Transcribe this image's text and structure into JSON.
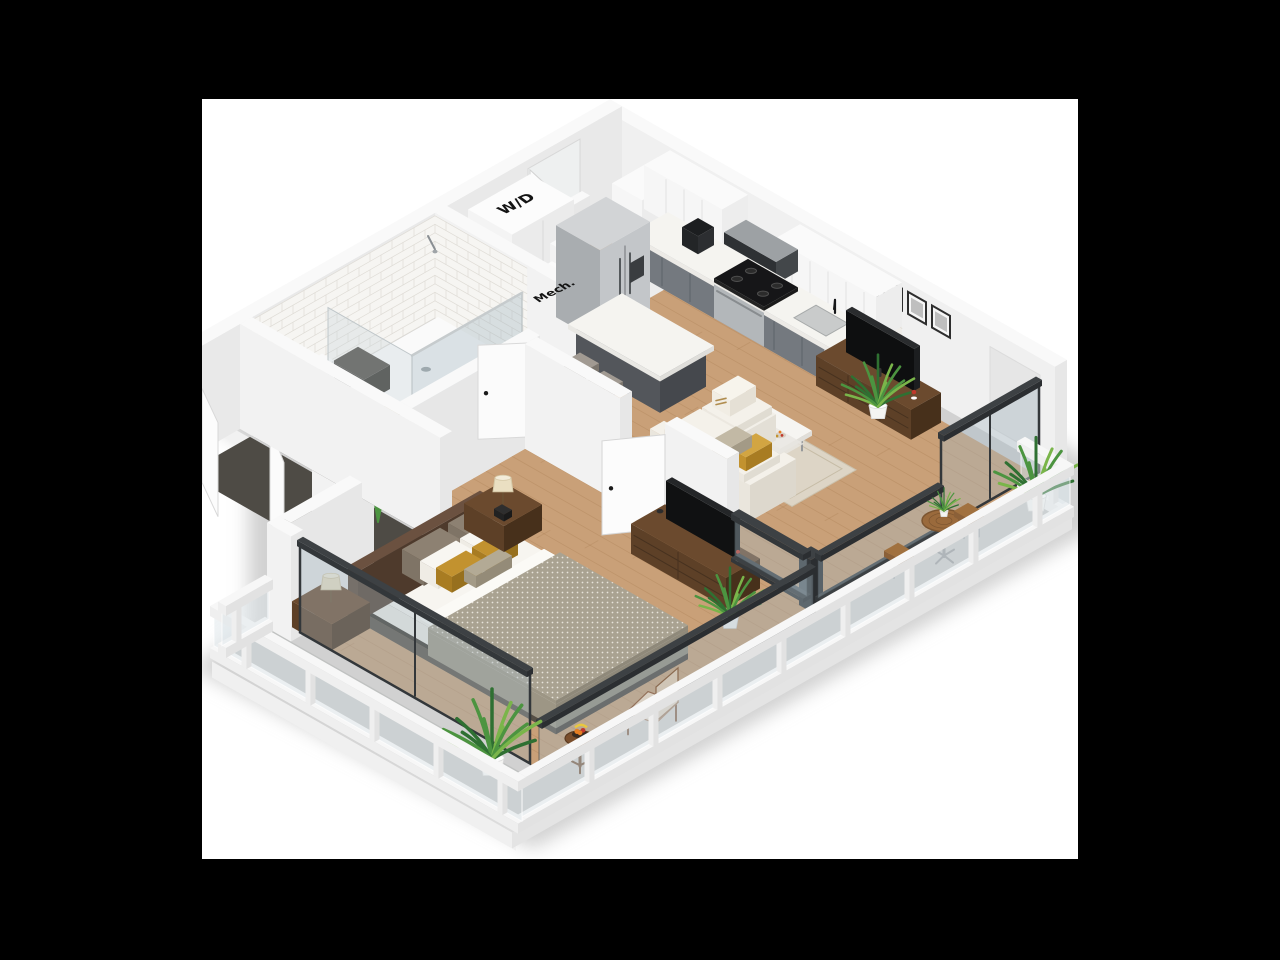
{
  "scene": {
    "description": "3D isometric rendering of a one-bedroom apartment floor plan on a white card over a black background",
    "canvas": {
      "x": 202,
      "y": 99,
      "width": 876,
      "height": 760
    }
  },
  "labels": {
    "washer_dryer": "W/D",
    "mechanical": "Mech."
  },
  "palette": {
    "background": "#000000",
    "canvas": "#ffffff",
    "shadow": "#c6c6c6",
    "wallTop": "#f9f9f9",
    "wallInnerNE": "#f0f0f0",
    "wallInnerNW": "#e9e9e9",
    "wallCap": "#e7e7e7",
    "wallOuter": "#f2f2f2",
    "wood": "#c9a078",
    "woodLine": "#a87e52",
    "tileFloor": "#edebe7",
    "tileLine": "#d9d6d0",
    "tileWall": "#f6f5f2",
    "tileWallLine": "#dfdcd6",
    "concrete": "#c0c2c1",
    "rug": "#ddd5c6",
    "closetFloor": "#4e4b45",
    "cabinetGray": "#74797f",
    "cabinetGrayDark": "#60656b",
    "islandGray": "#53565b",
    "counter": "#f5f4f0",
    "steel": "#c3c6c9",
    "steelSide": "#a9adb0",
    "applianceBlack": "#222426",
    "walnut": "#5d4027",
    "walnutDark": "#47301b",
    "sofa": "#efece5",
    "cushion": "#f4f1ea",
    "mattress": "#f7f5f0",
    "duvet": "#a9a291",
    "sheet": "#fbfaf6",
    "mustard": "#c2922f",
    "taupe": "#8d8172",
    "headboard": "#5a4434",
    "frameDark": "#33373a",
    "glass": "rgba(165,185,195,0.38)",
    "glassLight": "rgba(195,208,214,0.30)",
    "railWhite": "#f7f7f7",
    "railA": "#efefef",
    "railB": "#e2e2e2",
    "leaf1": "#2f7032",
    "leaf2": "#4c9440",
    "leaf3": "#7ab54a",
    "pot": "#f4f4f2",
    "tan": "#c8b287",
    "beige": "#d9d0c3",
    "fruitOrange": "#e67e22",
    "fruitRed": "#c0392b",
    "banana": "#e8c83e",
    "labelColor": "#141414"
  }
}
